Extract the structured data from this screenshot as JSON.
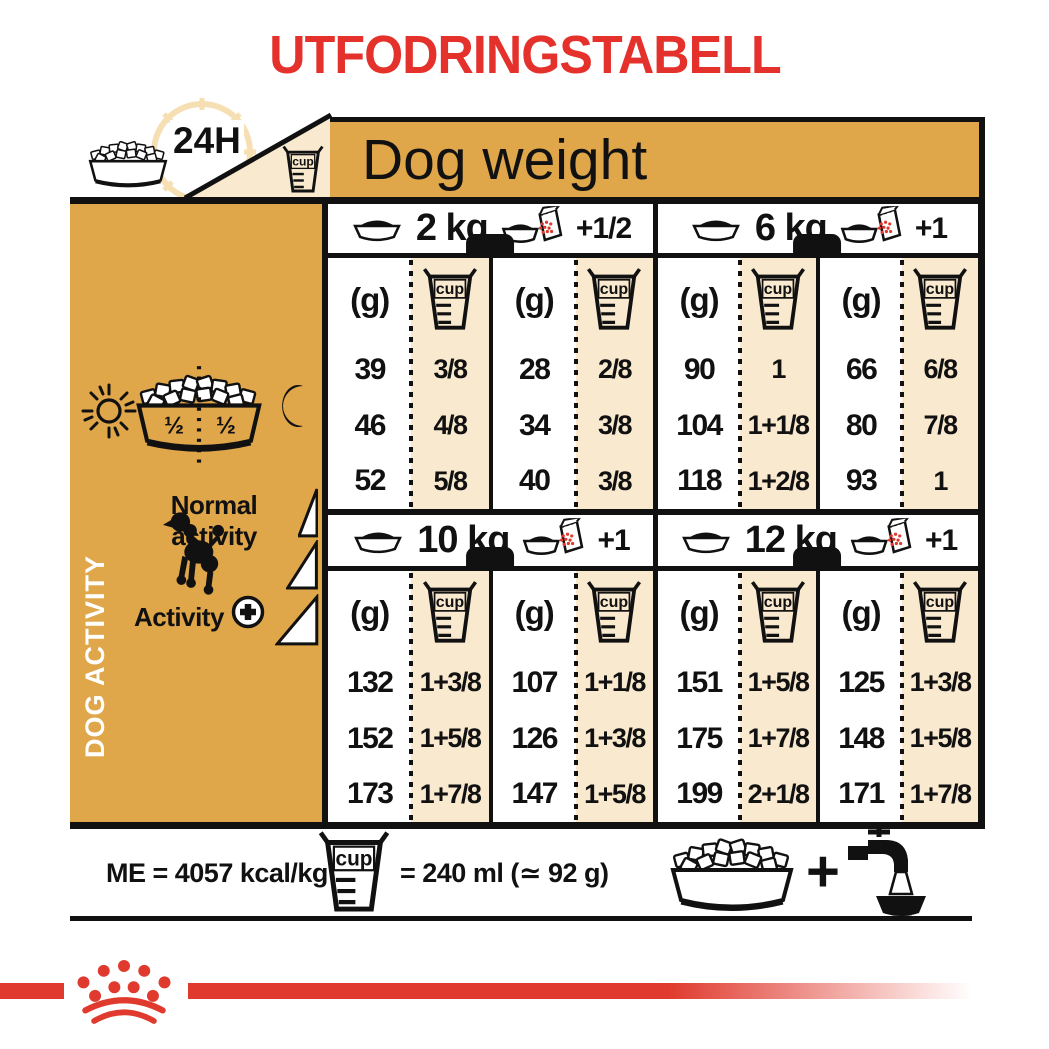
{
  "title": "UTFODRINGSTABELL",
  "colors": {
    "gold": "#DFA64A",
    "cream": "#F9E9CF",
    "red": "#E5312B",
    "brand_red": "#E03A2E",
    "ink": "#111111",
    "clock": "#F6DFB2"
  },
  "header": {
    "clock_label": "24H",
    "dog_weight_label": "Dog weight"
  },
  "sidebar": {
    "vertical_label": "DOG ACTIVITY",
    "bowl_left_fraction": "½",
    "bowl_right_fraction": "½",
    "normal_activity_label": "Normal activity",
    "activity_label": "Activity",
    "activity_plus": "+"
  },
  "table": {
    "gram_header": "(g)",
    "cup_header": "cup",
    "quadrants": [
      {
        "weight": "2 kg",
        "extra": "+1/2",
        "cols": [
          {
            "g": [
              "39",
              "46",
              "52"
            ],
            "cup": [
              "3/8",
              "4/8",
              "5/8"
            ]
          },
          {
            "g": [
              "28",
              "34",
              "40"
            ],
            "cup": [
              "2/8",
              "3/8",
              "3/8"
            ]
          }
        ]
      },
      {
        "weight": "6 kg",
        "extra": "+1",
        "cols": [
          {
            "g": [
              "90",
              "104",
              "118"
            ],
            "cup": [
              "1",
              "1+1/8",
              "1+2/8"
            ]
          },
          {
            "g": [
              "66",
              "80",
              "93"
            ],
            "cup": [
              "6/8",
              "7/8",
              "1"
            ]
          }
        ]
      },
      {
        "weight": "10 kg",
        "extra": "+1",
        "cols": [
          {
            "g": [
              "132",
              "152",
              "173"
            ],
            "cup": [
              "1+3/8",
              "1+5/8",
              "1+7/8"
            ]
          },
          {
            "g": [
              "107",
              "126",
              "147"
            ],
            "cup": [
              "1+1/8",
              "1+3/8",
              "1+5/8"
            ]
          }
        ]
      },
      {
        "weight": "12 kg",
        "extra": "+1",
        "cols": [
          {
            "g": [
              "151",
              "175",
              "199"
            ],
            "cup": [
              "1+5/8",
              "1+7/8",
              "2+1/8"
            ]
          },
          {
            "g": [
              "125",
              "148",
              "171"
            ],
            "cup": [
              "1+3/8",
              "1+5/8",
              "1+7/8"
            ]
          }
        ]
      }
    ]
  },
  "footer": {
    "me_label": "ME = 4057 kcal/kg",
    "cup_equiv_label": "= 240 ml (≃ 92 g)",
    "plus": "+"
  }
}
